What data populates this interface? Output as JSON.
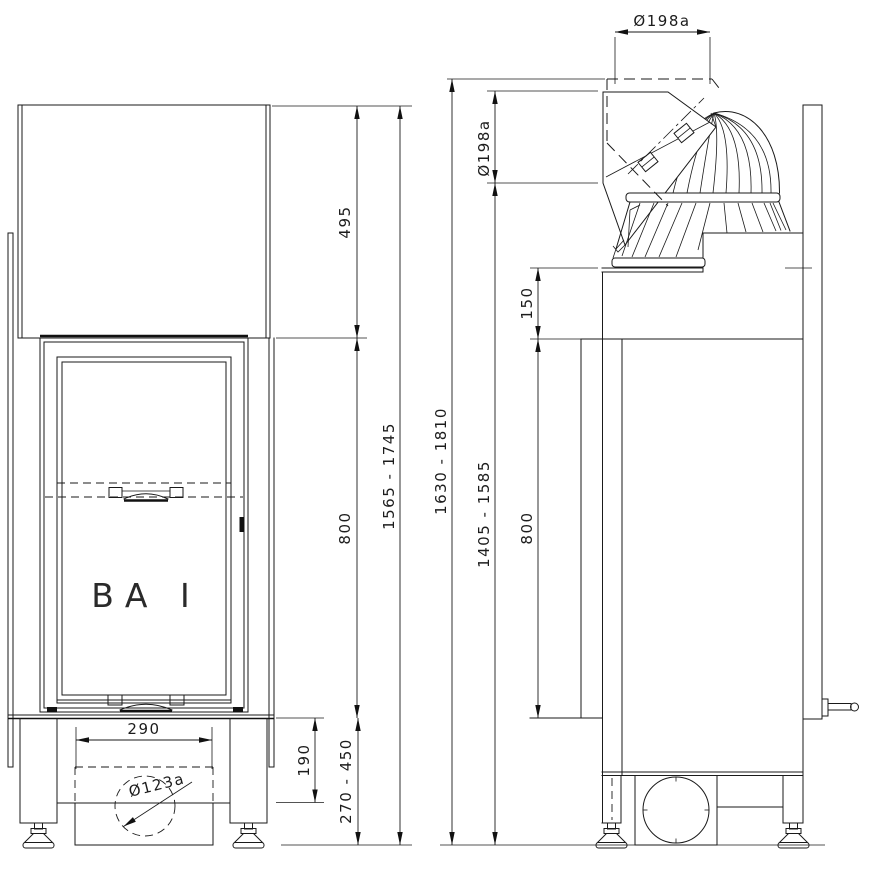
{
  "drawing": {
    "background": "#ffffff",
    "line_color": "#1a1a1a",
    "model_label": "BA I",
    "dimensions": {
      "hood_height": "495",
      "firebox_height_front": "800",
      "front_total_height_range": "1565 - 1745",
      "overall_height_range": "1630 - 1810",
      "base_opening_width": "290",
      "base_opening_height": "190",
      "plinth_height_range": "270 - 450",
      "air_inlet_diameter": "Ø123a",
      "flue_diameter_top": "Ø198a",
      "flue_diameter_rear": "Ø198a",
      "flue_height_range": "1405 - 1585",
      "collar_height": "150",
      "firebox_height_side": "800"
    }
  }
}
